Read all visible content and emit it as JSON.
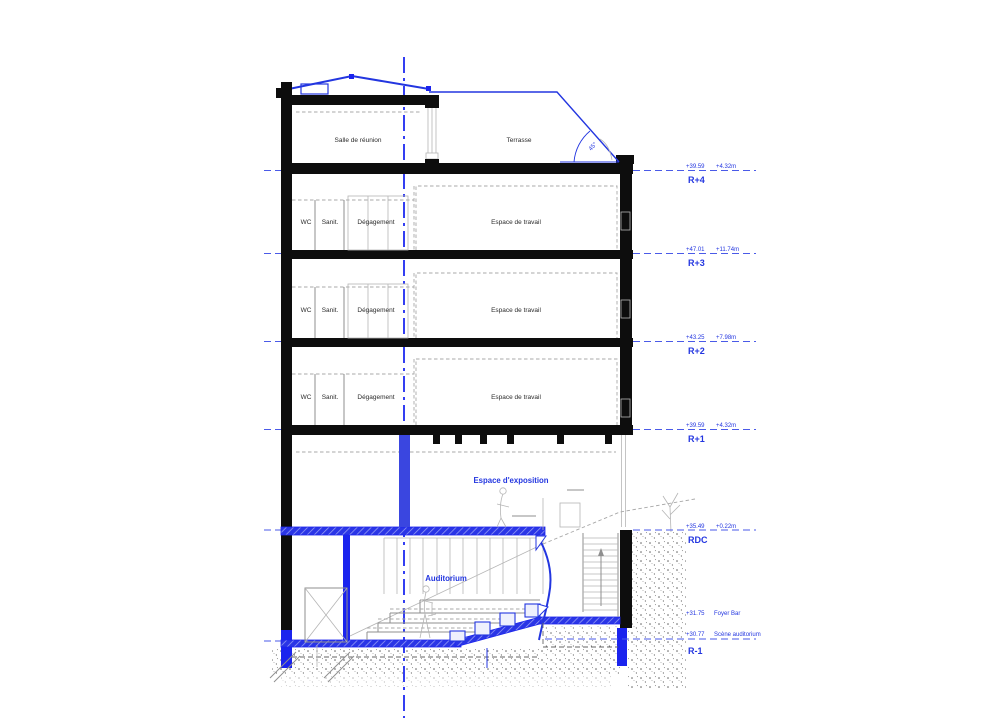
{
  "drawing": {
    "kind": "building-section",
    "rooms": {
      "salle_reunion": "Salle de réunion",
      "terrasse": "Terrasse",
      "wc": "WC",
      "sanit": "Sanit.",
      "degagement": "Dégagement",
      "espace_travail": "Espace de travail",
      "espace_exposition": "Espace d'exposition",
      "auditorium": "Auditorium"
    },
    "levels": [
      {
        "name": "R+4",
        "elev": "+39.59",
        "rel": "+4.32m"
      },
      {
        "name": "R+3",
        "elev": "+47.01",
        "rel": "+11.74m"
      },
      {
        "name": "R+2",
        "elev": "+43.25",
        "rel": "+7.98m"
      },
      {
        "name": "R+1",
        "elev": "+39.59",
        "rel": "+4.32m"
      },
      {
        "name": "RDC",
        "elev": "+35.49",
        "rel": "+0.22m"
      }
    ],
    "basement": {
      "name": "R-1",
      "foyer_elev": "+31.75",
      "foyer_label": "Foyer Bar",
      "stage_elev": "+30.77",
      "stage_label": "Scène auditorium"
    },
    "annotations": {
      "roof_angle": "45°"
    },
    "colors": {
      "accent_blue": "#2336e0",
      "below_grade_blue": "#1b24ee",
      "slab_blue": "#2a35e6",
      "wall_black": "#0d0d0d",
      "detail_gray": "#8f8f8f"
    }
  }
}
